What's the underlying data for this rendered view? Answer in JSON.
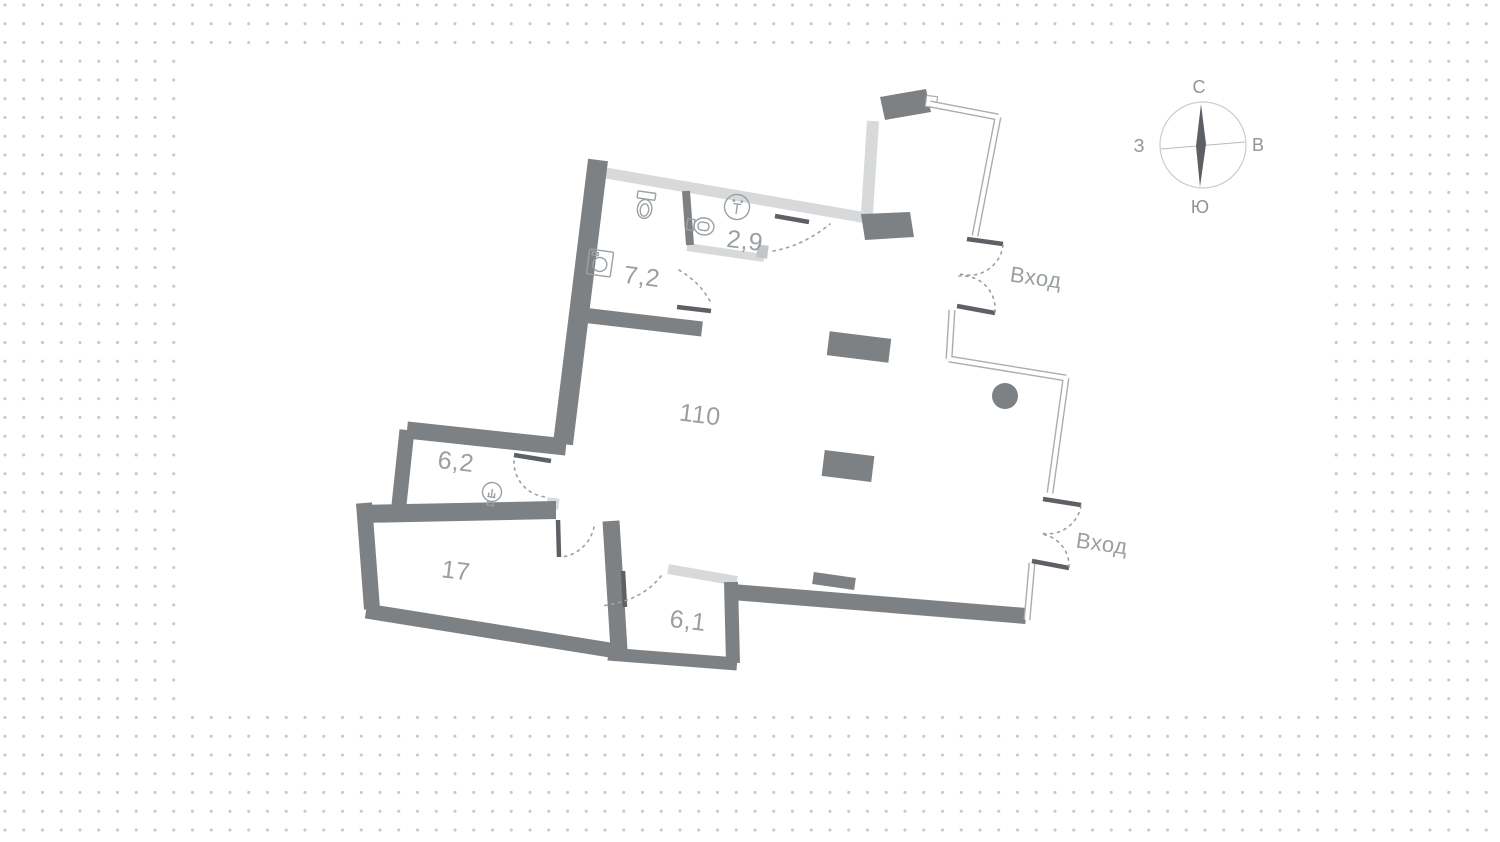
{
  "plan": {
    "rooms": [
      {
        "name": "open-space",
        "area": "110"
      },
      {
        "name": "bathroom",
        "area": "7,2"
      },
      {
        "name": "wc",
        "area": "2,9"
      },
      {
        "name": "storage",
        "area": "6,2"
      },
      {
        "name": "room-17",
        "area": "17"
      },
      {
        "name": "hallway",
        "area": "6,1"
      }
    ],
    "entrances": [
      {
        "name": "entrance-east-upper",
        "label": "Вход"
      },
      {
        "name": "entrance-east-lower",
        "label": "Вход"
      }
    ],
    "icons": [
      "toilet-icon",
      "washing-machine-icon",
      "sink-icon",
      "ventilation-icon",
      "washbasin-icon",
      "column-icon"
    ],
    "colors": {
      "wall": "#7e8184",
      "light_wall": "#d7d9da",
      "window_outline": "#a9adb0",
      "door_leaf": "#5d6165",
      "label_text": "#9a9fa2",
      "dot_grid": "#c8c9ca",
      "sheet": "#ffffff"
    }
  },
  "compass": {
    "north": "С",
    "south": "Ю",
    "west": "З",
    "east": "В"
  }
}
